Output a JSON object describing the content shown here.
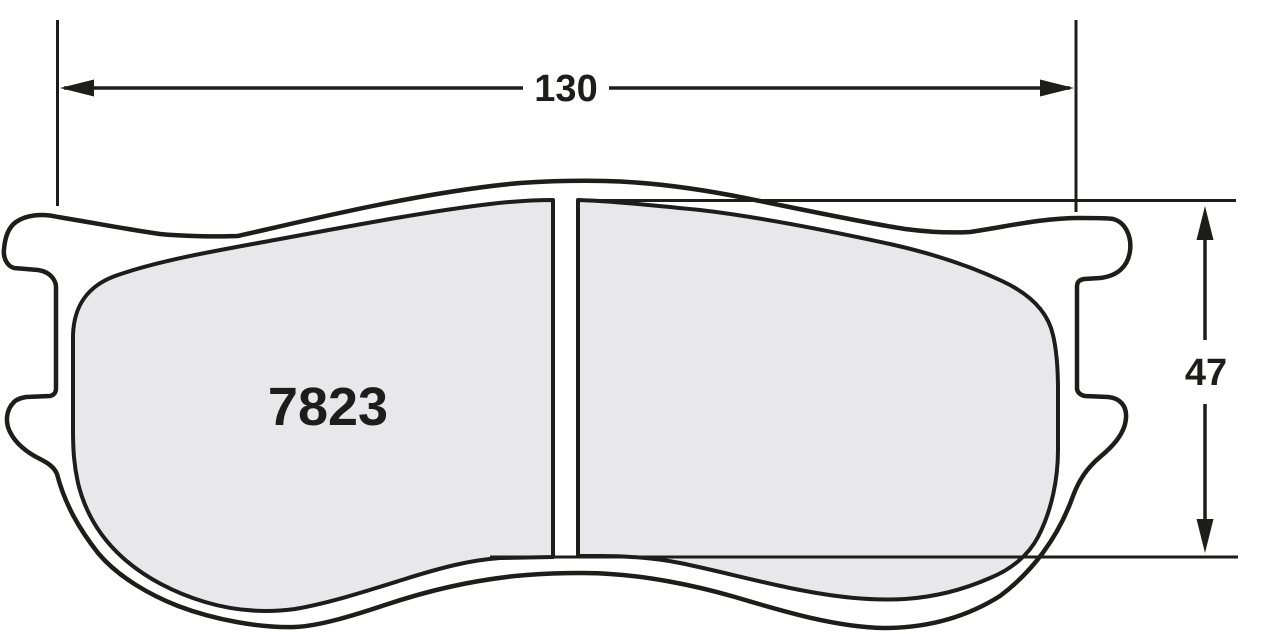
{
  "drawing": {
    "title": "Brake pad outline drawing",
    "part_number": "7823",
    "dimensions": {
      "width": {
        "value": "130"
      },
      "height": {
        "value": "47"
      }
    },
    "colors": {
      "line": "#1d1d1b",
      "friction_fill": "#e8e8ea",
      "background": "#ffffff"
    }
  }
}
